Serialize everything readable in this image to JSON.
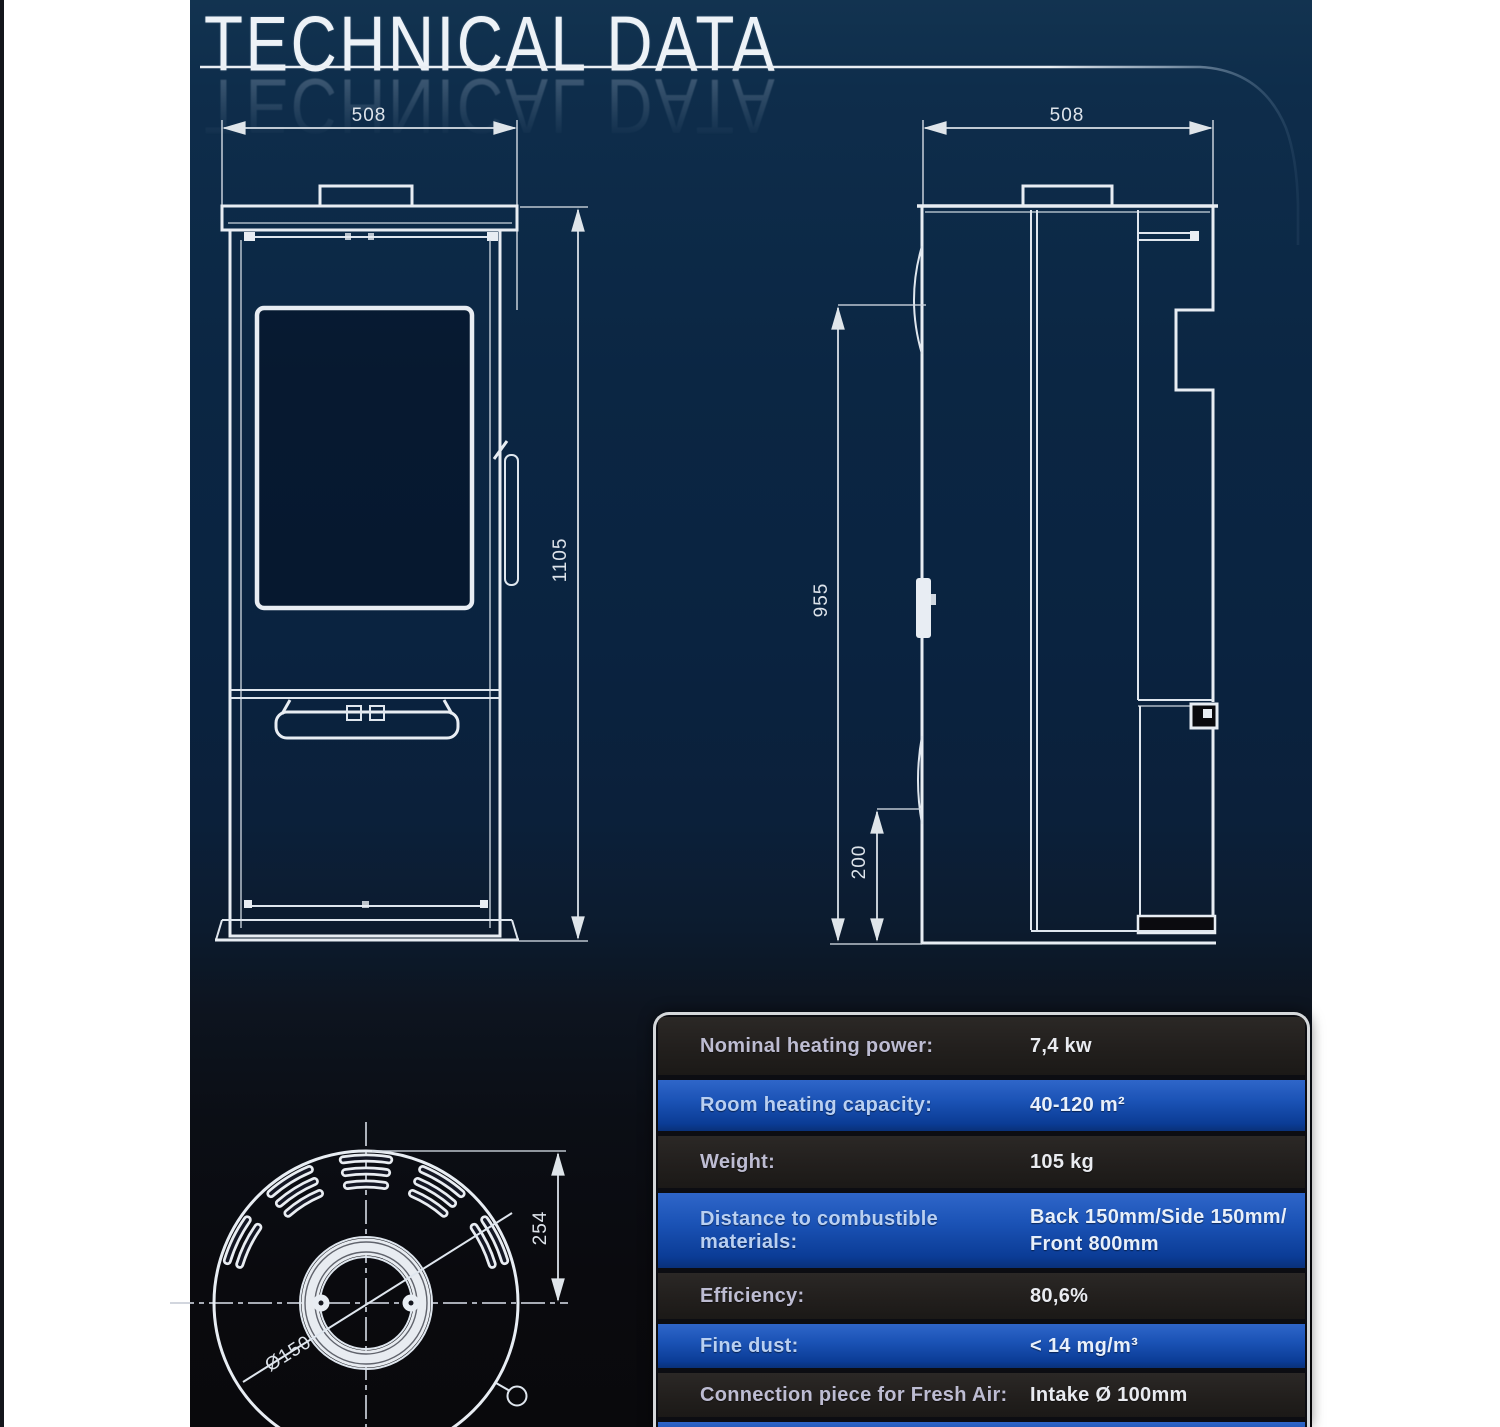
{
  "title": "TECHNICAL DATA",
  "dimensions": {
    "front_width": "508",
    "front_height": "1105",
    "side_depth": "508",
    "side_rear_height": "955",
    "side_lower_height": "200",
    "top_offset": "254",
    "flue_diameter": "Ø150"
  },
  "spec_table": {
    "rows": [
      {
        "label": "Nominal heating power:",
        "value": "7,4 kw"
      },
      {
        "label": "Room heating capacity:",
        "value": "40-120 m²"
      },
      {
        "label": "Weight:",
        "value": "105 kg"
      },
      {
        "label": "Distance to combustible materials:",
        "value": "Back 150mm/Side 150mm/\nFront 800mm"
      },
      {
        "label": "Efficiency:",
        "value": "80,6%"
      },
      {
        "label": "Fine dust:",
        "value": "< 14 mg/m³"
      },
      {
        "label": "Connection piece for Fresh Air:",
        "value": "Intake Ø 100mm"
      }
    ]
  },
  "colors": {
    "accent_blue": "#1b53b6",
    "row_dark": "#242120",
    "background_navy_top": "#123350",
    "background_bottom": "#09090c",
    "drawing_line": "#e8edf3",
    "page_margin": "#ffffff"
  }
}
